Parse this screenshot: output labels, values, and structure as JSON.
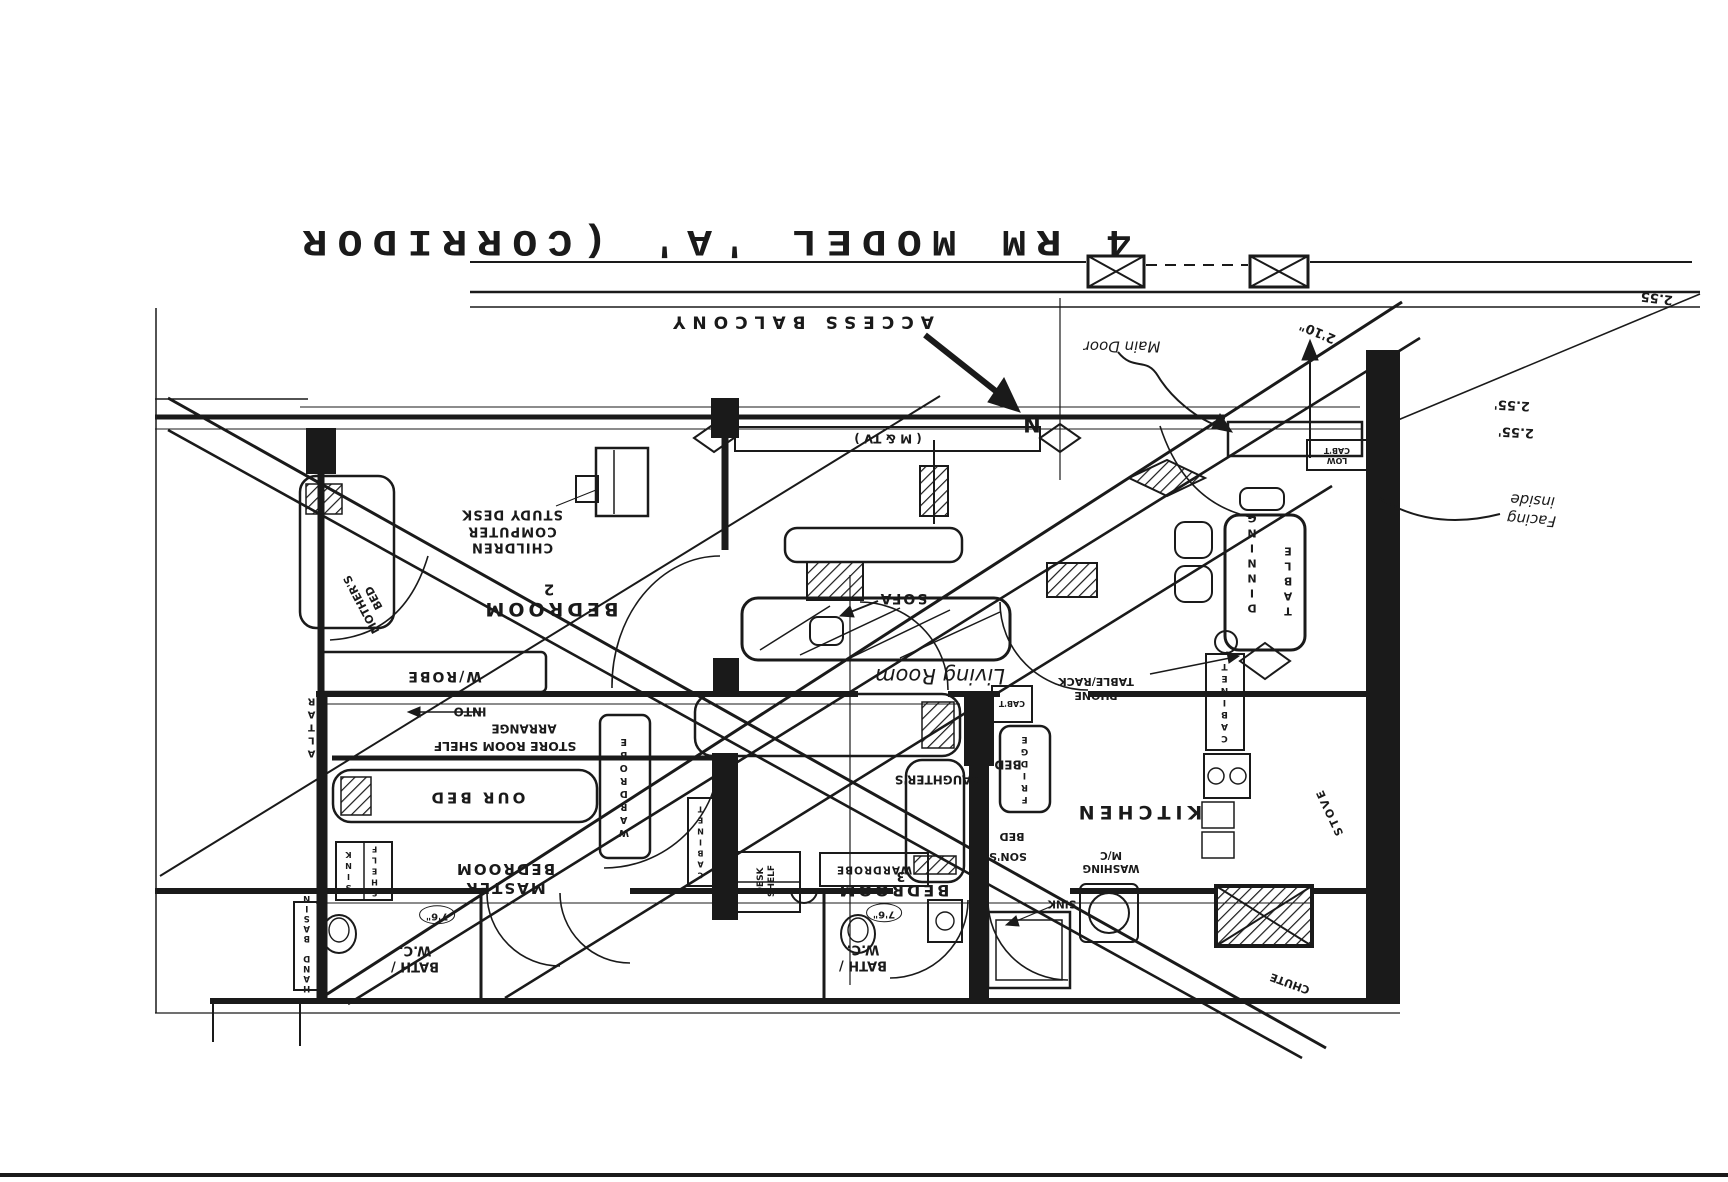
{
  "document": {
    "type": "scanned hand-drawn floor plan, rotated 180 degrees (all text upside down)",
    "ink_color": "#1a1a1a",
    "paper_color": "#ffffff"
  },
  "labels": {
    "title": "4  RM  MODEL  'A'  (CORRIDOR",
    "access_balcony": "ACCESS  BALCONY",
    "main_door": "Main Door",
    "dim_2_10": "2'10\"",
    "dim_2_55_corner": "2.55",
    "dim_2_55_a": "2.55'",
    "dim_2_55_b": "2.55'",
    "facing_inside": "Facing\ninside",
    "n_marker": "N",
    "tv_m": "( M  &  TV )",
    "low_cab": "LOW\nCAB'T",
    "children_study": "CHILDREN\nCOMPUTER\nSTUDY DESK",
    "bedroom2": "BEDROOM",
    "bedroom2_no": "2",
    "mothers_bed": "MOTHER'S\nBED",
    "w_robe": "W/ROBE",
    "into": "INTO",
    "arrange": "ARRANGE",
    "store_shelf": "STORE ROOM SHELF",
    "altar": "ALTAR",
    "our_bed": "OUR  BED",
    "master_bedroom": "MASTER\nBEDROOM",
    "sink_v": "SINK",
    "shelf_v": "SHELF",
    "hand_basin": "HAND BASIN",
    "wardrobe_master": "WARDROBE",
    "bath_left": "BATH /\nW.C.",
    "dim_bath_left": "7'6\"",
    "bath_center": "BATH /\nW.C.",
    "dim_bath_center": "7'6\"",
    "sofa": "SOFA",
    "living_room": "Living Room",
    "dinning": "DINNING",
    "table": "TABLE",
    "phone_rack": "PHONE\nTABLE/RACK",
    "cabinet_right": "CABINET",
    "kitchen": "KITCHEN",
    "washing_mc": "WASHING\nM/C",
    "sink_kitchen": "SINK",
    "fridge": "FRIDGE",
    "cabt": "CAB'T",
    "stove": "STOVE",
    "chute": "CHUTE",
    "bedroom3": "BEDROOM",
    "bedroom3_no": "3",
    "daughters": "DAUGHTER'S",
    "daughters_bed": "BED",
    "sons": "SON'S",
    "sons_bed": "BED",
    "cabinet_center": "CABINET",
    "wardrobe_3": "WARDROBE",
    "desk_shelf": "DESK\nSHELF"
  }
}
